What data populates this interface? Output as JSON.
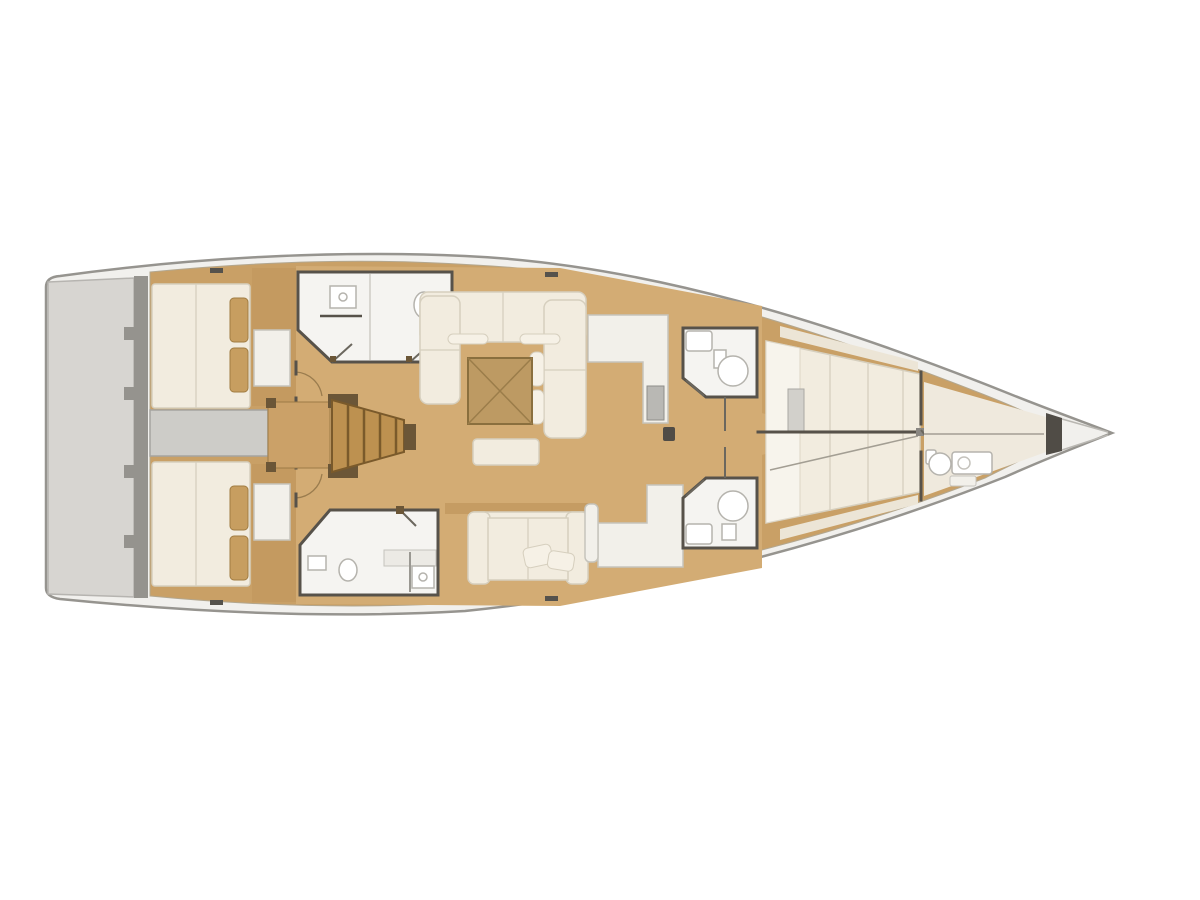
{
  "diagram": {
    "type": "yacht-interior-floor-plan",
    "orientation": "bow-right",
    "regions": [
      {
        "id": "swim-platform"
      },
      {
        "id": "transom-steps"
      },
      {
        "id": "aft-cabin-port"
      },
      {
        "id": "aft-cabin-starboard"
      },
      {
        "id": "engine-room"
      },
      {
        "id": "companionway-steps"
      },
      {
        "id": "aft-head-port"
      },
      {
        "id": "aft-head-starboard"
      },
      {
        "id": "saloon-dinette"
      },
      {
        "id": "saloon-table"
      },
      {
        "id": "saloon-sofa"
      },
      {
        "id": "galley-port"
      },
      {
        "id": "galley-starboard"
      },
      {
        "id": "mast-post"
      },
      {
        "id": "mid-head-port"
      },
      {
        "id": "mid-head-starboard"
      },
      {
        "id": "forward-cabin-port-berth"
      },
      {
        "id": "forward-cabin-starboard-berth"
      },
      {
        "id": "forward-head"
      },
      {
        "id": "chain-locker"
      },
      {
        "id": "bow"
      }
    ]
  },
  "colors": {
    "background": "#ffffff",
    "hull_fill": "#f1f0ed",
    "hull_stroke": "#96948f",
    "interior_wood": "#c9a066",
    "floor_light": "#d3ac74",
    "upholstery": "#f2ecdf",
    "upholstery_stroke": "#d6cfbe",
    "white_room": "#f5f4f1",
    "wall_dark": "#57524a",
    "platform_grey": "#d7d5d1",
    "band_grey": "#95938e",
    "engine_grey": "#cdccc8",
    "steps_wood": "#bd9150",
    "steps_dark": "#7a5a2b",
    "table_wood": "#bd9a63",
    "table_stroke": "#8a6f3e",
    "fixture_grey": "#b9b8b4",
    "pillow_tan": "#c79e60",
    "trim_brown": "#6b5637",
    "shadow_tan": "#b98f55"
  }
}
